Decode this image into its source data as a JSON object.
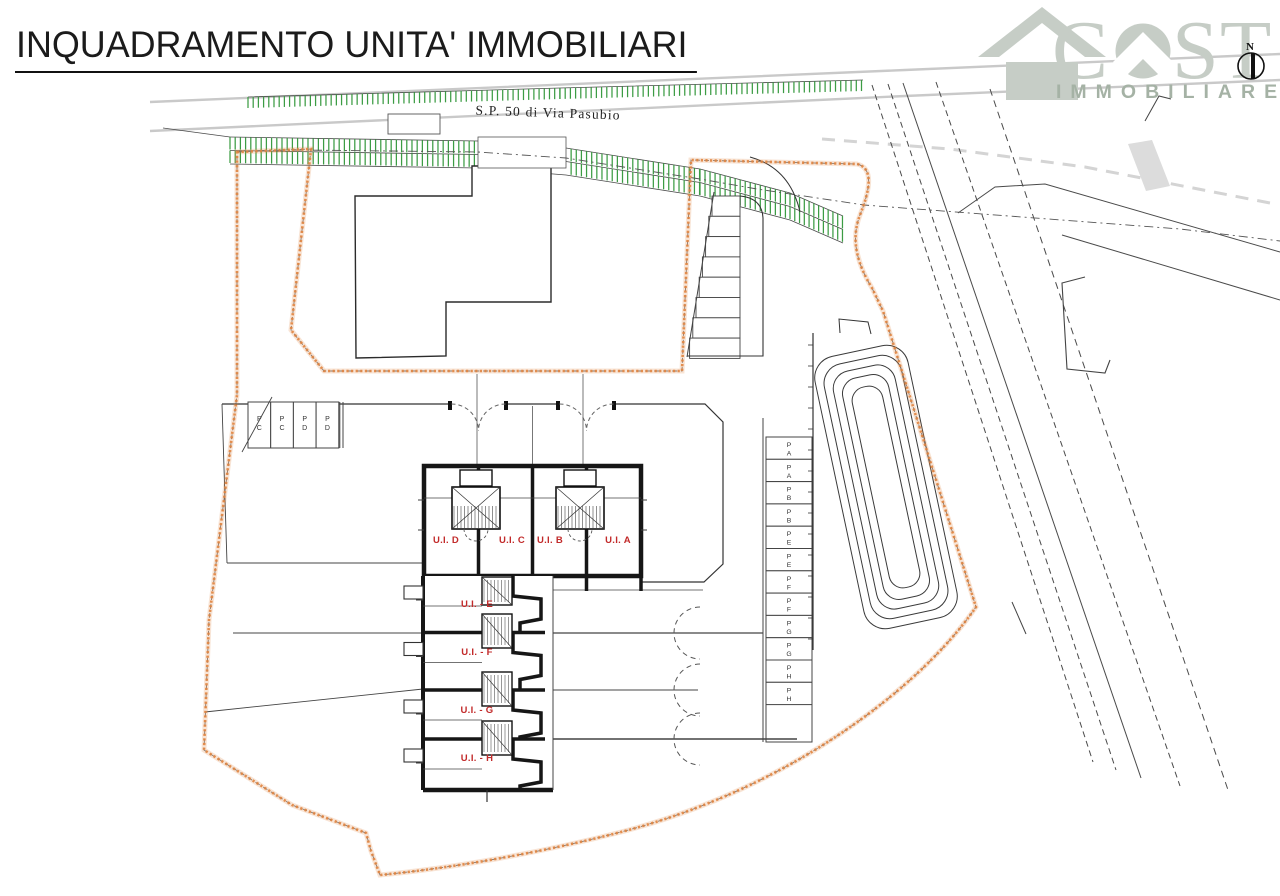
{
  "header": {
    "title": "INQUADRAMENTO UNITA' IMMOBILIARI"
  },
  "logo": {
    "word_parts": {
      "c": "C",
      "s": "S",
      "t": "T"
    },
    "subtitle": "IMMOBILIARE"
  },
  "north": {
    "label": "N"
  },
  "plan": {
    "road_label": "S.P. 50 di Via Pasubio",
    "unit_labels_top": [
      "U.I. D",
      "U.I. C",
      "U.I. B",
      "U.I. A"
    ],
    "unit_labels_row": [
      "U.I. - E",
      "U.I. - F",
      "U.I. - G",
      "U.I. - H"
    ],
    "parking_left": [
      "PC",
      "PC",
      "PD",
      "PD"
    ],
    "parking_right": [
      "PA",
      "PA",
      "PB",
      "PB",
      "PE",
      "PE",
      "PF",
      "PF",
      "PG",
      "PG",
      "PH",
      "PH"
    ],
    "colors": {
      "boundary_orange": "#e08440",
      "verge_green": "#3c9c44",
      "unit_label_red": "#c22a2a",
      "wall_black": "#161616",
      "thin_line": "#3d3d3d",
      "road_gray": "#c9c9c9",
      "logo_gray": "#c6cdc6",
      "logo_sub_gray": "#a5b2a5"
    }
  }
}
